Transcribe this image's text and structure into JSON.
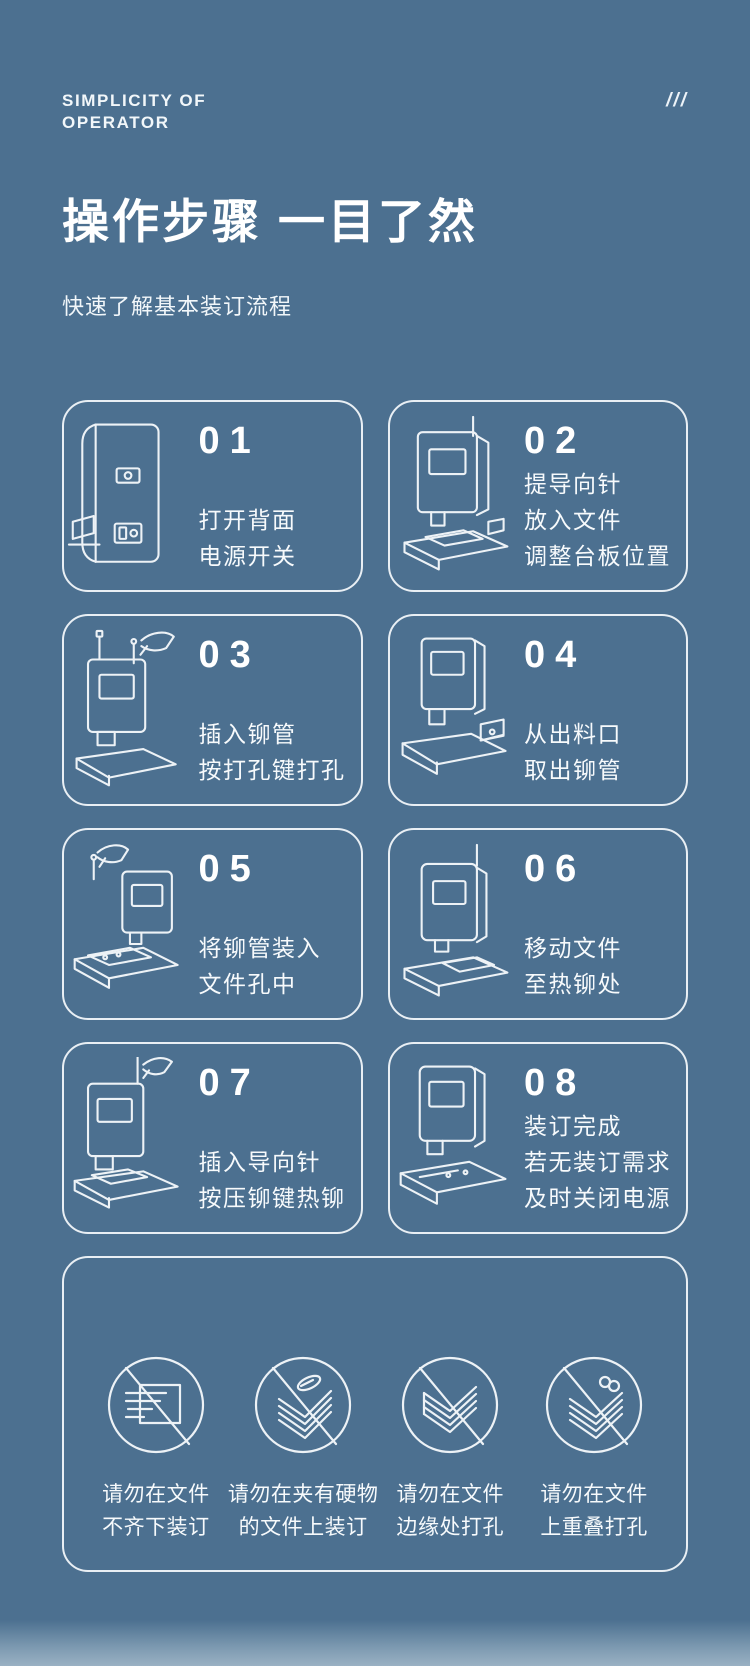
{
  "page": {
    "bg_color": "#4C7090",
    "line_color": "#EDF2F6",
    "text_color": "#F7FAFC"
  },
  "header": {
    "eyebrow_line1": "SIMPLICITY OF",
    "eyebrow_line2": "OPERATOR",
    "slashes": "///",
    "title": "操作步骤 一目了然",
    "subtitle": "快速了解基本装订流程"
  },
  "steps": [
    {
      "number": "01",
      "icon": "machine-back-panel",
      "lines": [
        "打开背面",
        "电源开关"
      ]
    },
    {
      "number": "02",
      "icon": "machine-front-platform",
      "lines": [
        "提导向针",
        "放入文件",
        "调整台板位置"
      ]
    },
    {
      "number": "03",
      "icon": "hand-insert-rivet-tube",
      "lines": [
        "插入铆管",
        "按打孔键打孔"
      ]
    },
    {
      "number": "04",
      "icon": "machine-outlet-tray",
      "lines": [
        "从出料口",
        "取出铆管"
      ]
    },
    {
      "number": "05",
      "icon": "hand-place-rivet-in-document",
      "lines": [
        "将铆管装入",
        "文件孔中"
      ]
    },
    {
      "number": "06",
      "icon": "machine-move-document",
      "lines": [
        "移动文件",
        "至热铆处"
      ]
    },
    {
      "number": "07",
      "icon": "hand-insert-guide-pin",
      "lines": [
        "插入导向针",
        "按压铆键热铆"
      ]
    },
    {
      "number": "08",
      "icon": "machine-binding-done",
      "lines": [
        "装订完成",
        "若无装订需求",
        "及时关闭电源"
      ]
    }
  ],
  "warnings": [
    {
      "icon": "no-uneven-documents",
      "lines": [
        "请勿在文件",
        "不齐下装订"
      ]
    },
    {
      "icon": "no-hard-objects-in-documents",
      "lines": [
        "请勿在夹有硬物",
        "的文件上装订"
      ]
    },
    {
      "icon": "no-punch-at-edge",
      "lines": [
        "请勿在文件",
        "边缘处打孔"
      ]
    },
    {
      "icon": "no-overlapping-punch",
      "lines": [
        "请勿在文件",
        "上重叠打孔"
      ]
    }
  ]
}
